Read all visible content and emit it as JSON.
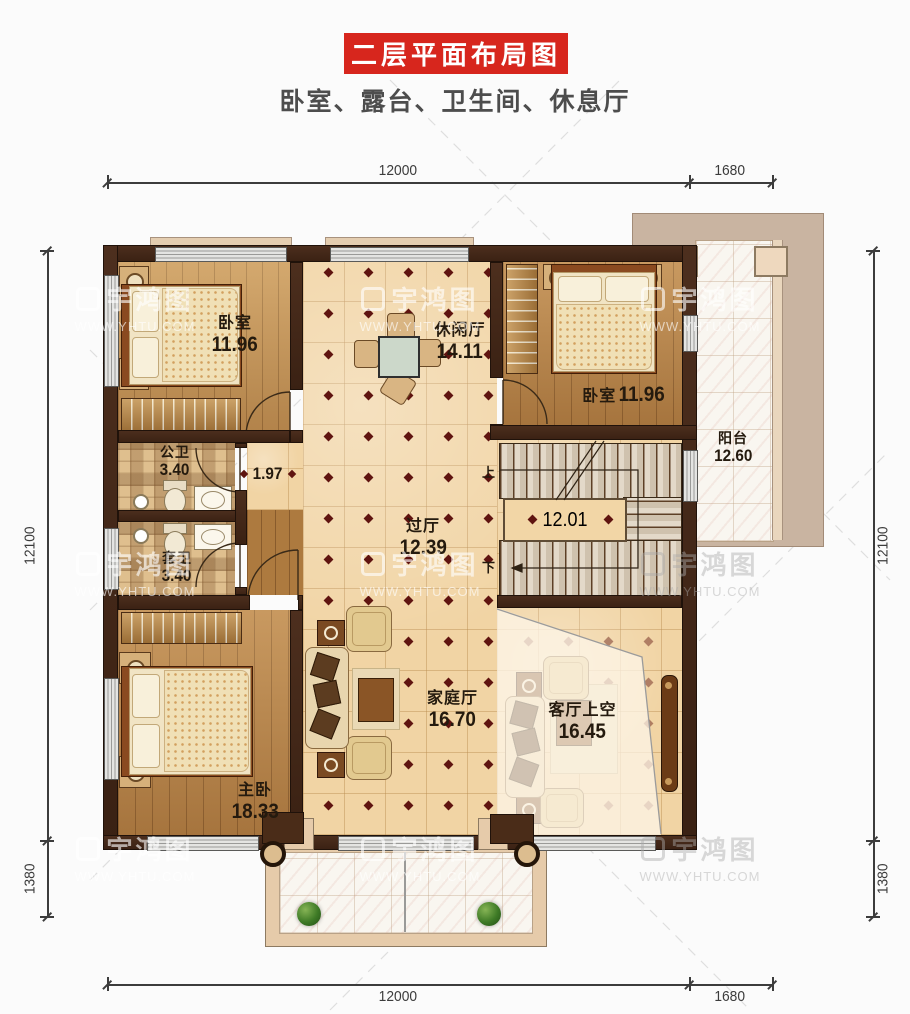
{
  "title": "二层平面布局图",
  "subtitle": "卧室、露台、卫生间、休息厅",
  "watermark": {
    "brand": "宇鸿图",
    "url": "WWW.YHTU.COM"
  },
  "dimensions": {
    "top": [
      "12000",
      "1680"
    ],
    "bottom": [
      "12000",
      "1680"
    ],
    "left": [
      "12100",
      "1380"
    ],
    "right": [
      "12100",
      "1380"
    ]
  },
  "rooms": {
    "bedroom_tl": {
      "name": "卧室",
      "area": "11.96"
    },
    "leisure": {
      "name": "休闲厅",
      "area": "14.11"
    },
    "bedroom_tr": {
      "name": "卧室",
      "area": "11.96"
    },
    "balcony": {
      "name": "阳台",
      "area": "12.60"
    },
    "public_bath": {
      "name": "公卫",
      "area": "3.40"
    },
    "ensuite_bath": {
      "name": "套卫",
      "area": "3.40"
    },
    "hallway": {
      "name": "过厅",
      "area": "12.39"
    },
    "stairwell": {
      "area": "12.01",
      "up": "上",
      "down": "下"
    },
    "corridor": {
      "width": "1.97"
    },
    "master": {
      "name": "主卧",
      "area": "18.33"
    },
    "family": {
      "name": "家庭厅",
      "area": "16.70"
    },
    "living_void": {
      "name": "客厅上空",
      "area": "16.45"
    }
  },
  "colors": {
    "accent_red": "#d7261d",
    "wall": "#40291a",
    "tile": "#f1d4a4",
    "wood": "#b9854a",
    "marble": "#f9f6f0",
    "diamond_marker": "#5f1410"
  }
}
